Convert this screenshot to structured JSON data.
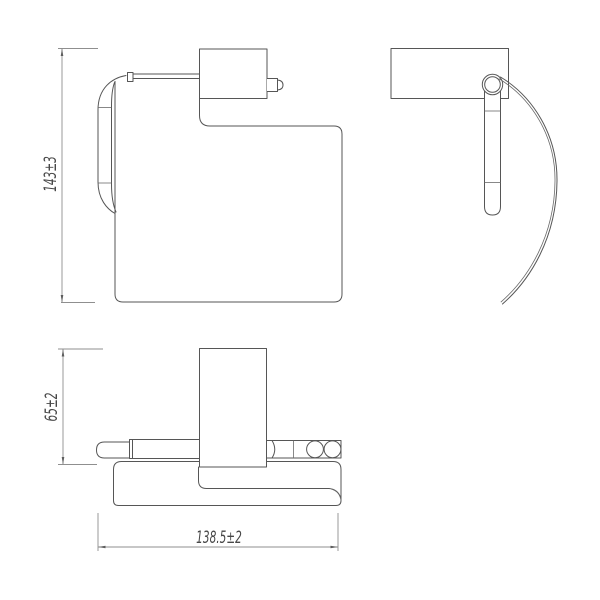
{
  "drawing": {
    "background_color": "#ffffff",
    "object_line_color": "#565656",
    "dimension_line_color": "#8f8f8f",
    "text_color": "#474747",
    "dimensions": {
      "front_height": {
        "label": "143±3"
      },
      "top_depth": {
        "label": "65±2"
      },
      "overall_width": {
        "label": "138.5±2"
      }
    }
  }
}
